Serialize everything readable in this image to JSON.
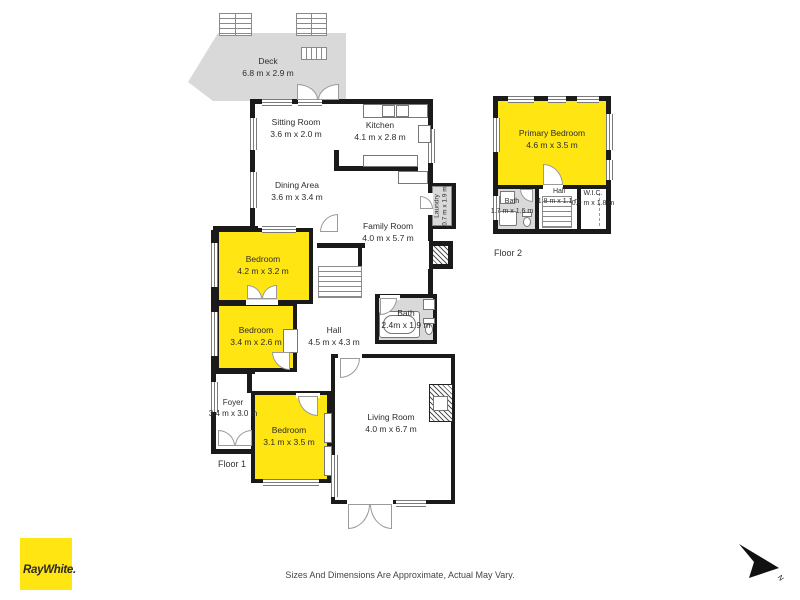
{
  "deck": {
    "name": "Deck",
    "dims": "6.8 m x 2.9 m"
  },
  "rooms": {
    "sitting": {
      "name": "Sitting Room",
      "dims": "3.6 m x 2.0 m"
    },
    "kitchen": {
      "name": "Kitchen",
      "dims": "4.1 m x 2.8 m"
    },
    "dining": {
      "name": "Dining Area",
      "dims": "3.6 m x 3.4 m"
    },
    "family": {
      "name": "Family Room",
      "dims": "4.0 m x 5.7 m"
    },
    "laundry": {
      "name": "Laundry",
      "dims": "0.7 m x 1.9 m"
    },
    "bed1": {
      "name": "Bedroom",
      "dims": "4.2 m x 3.2 m"
    },
    "bed2": {
      "name": "Bedroom",
      "dims": "3.4 m x 2.6 m"
    },
    "hall1": {
      "name": "Hall",
      "dims": "4.5 m x 4.3 m"
    },
    "bath1": {
      "name": "Bath",
      "dims": "2.4m x 1.9 m"
    },
    "foyer": {
      "name": "Foyer",
      "dims": "3.4 m x 3.0 m"
    },
    "bed3": {
      "name": "Bedroom",
      "dims": "3.1 m x 3.5 m"
    },
    "living": {
      "name": "Living Room",
      "dims": "4.0 m x 6.7 m"
    },
    "primary": {
      "name": "Primary Bedroom",
      "dims": "4.6 m x 3.5 m"
    },
    "bath2": {
      "name": "Bath",
      "dims": "1.7 m x 1.6 m"
    },
    "hall2": {
      "name": "Hall",
      "dims": "1.8 m x 1.1 m"
    },
    "wic": {
      "name": "W.I.C.",
      "dims": "0.9 m x 1.8 m"
    }
  },
  "floors": {
    "floor1": "Floor 1",
    "floor2": "Floor 2"
  },
  "footer": {
    "logo": "RayWhite.",
    "disclaimer": "Sizes And Dimensions Are Approximate, Actual May Vary.",
    "north": "N"
  },
  "colors": {
    "highlight": "#ffe512",
    "wall": "#1a1a1a",
    "secondary": "#d9d9d9"
  }
}
